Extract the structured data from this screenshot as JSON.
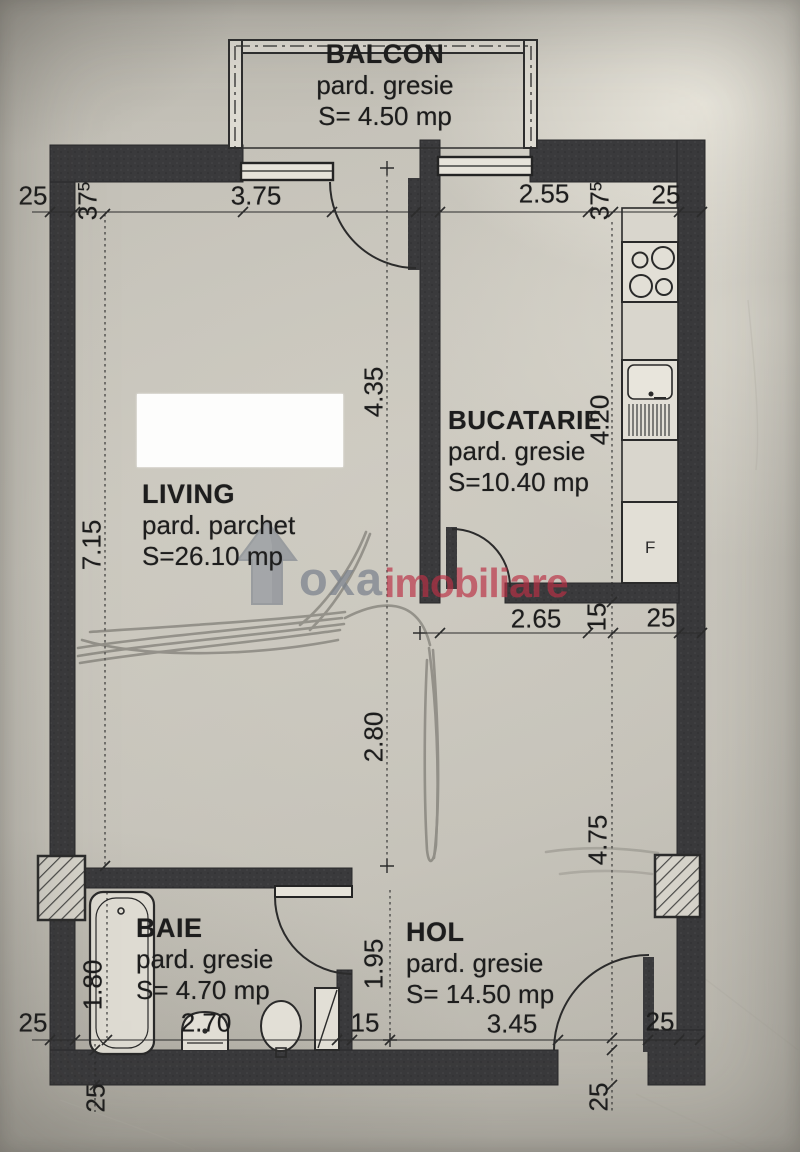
{
  "plan": {
    "rooms": {
      "balcon": {
        "name": "BALCON",
        "floor": "pard. gresie",
        "area": "S= 4.50  mp"
      },
      "living": {
        "name": "LIVING",
        "floor": "pard. parchet",
        "area": "S=26.10  mp"
      },
      "bucatarie": {
        "name": "BUCATARIE",
        "floor": "pard. gresie",
        "area": "S=10.40 mp"
      },
      "baie": {
        "name": "BAIE",
        "floor": "pard. gresie",
        "area": "S= 4.70 mp"
      },
      "hol": {
        "name": "HOL",
        "floor": "pard. gresie",
        "area": "S= 14.50 mp"
      }
    },
    "dims": {
      "top_left_25": "25",
      "wall_thick_main": "37",
      "wall_thick_sup": "5",
      "living_width": "3.75",
      "kitchen_width": "2.55",
      "top_right_25": "25",
      "living_upper_height": "4.35",
      "kitchen_height": "4.20",
      "living_height": "7.15",
      "hall_top_width": "2.65",
      "wall_15_mid": "15",
      "mid_right_25": "25",
      "living_lower_height": "2.80",
      "hall_right_height": "4.75",
      "bath_height": "1.80",
      "bath_width": "2.70",
      "hall_left_height": "1.95",
      "wall_15_bottom": "15",
      "hall_width": "3.45",
      "entry_25": "25",
      "bottom_left_25": "25",
      "below_left_25": "25",
      "below_right_25": "25"
    },
    "fixtures": {
      "fridge_label": "F"
    },
    "watermark": {
      "brand": "oxa",
      "suffix": "imobiliare",
      "gray": "#8b919b",
      "red": "#c23a4e"
    },
    "colors": {
      "wall": "#38383a",
      "paper": "#c3c0b7",
      "line": "#2c2c2c"
    }
  }
}
